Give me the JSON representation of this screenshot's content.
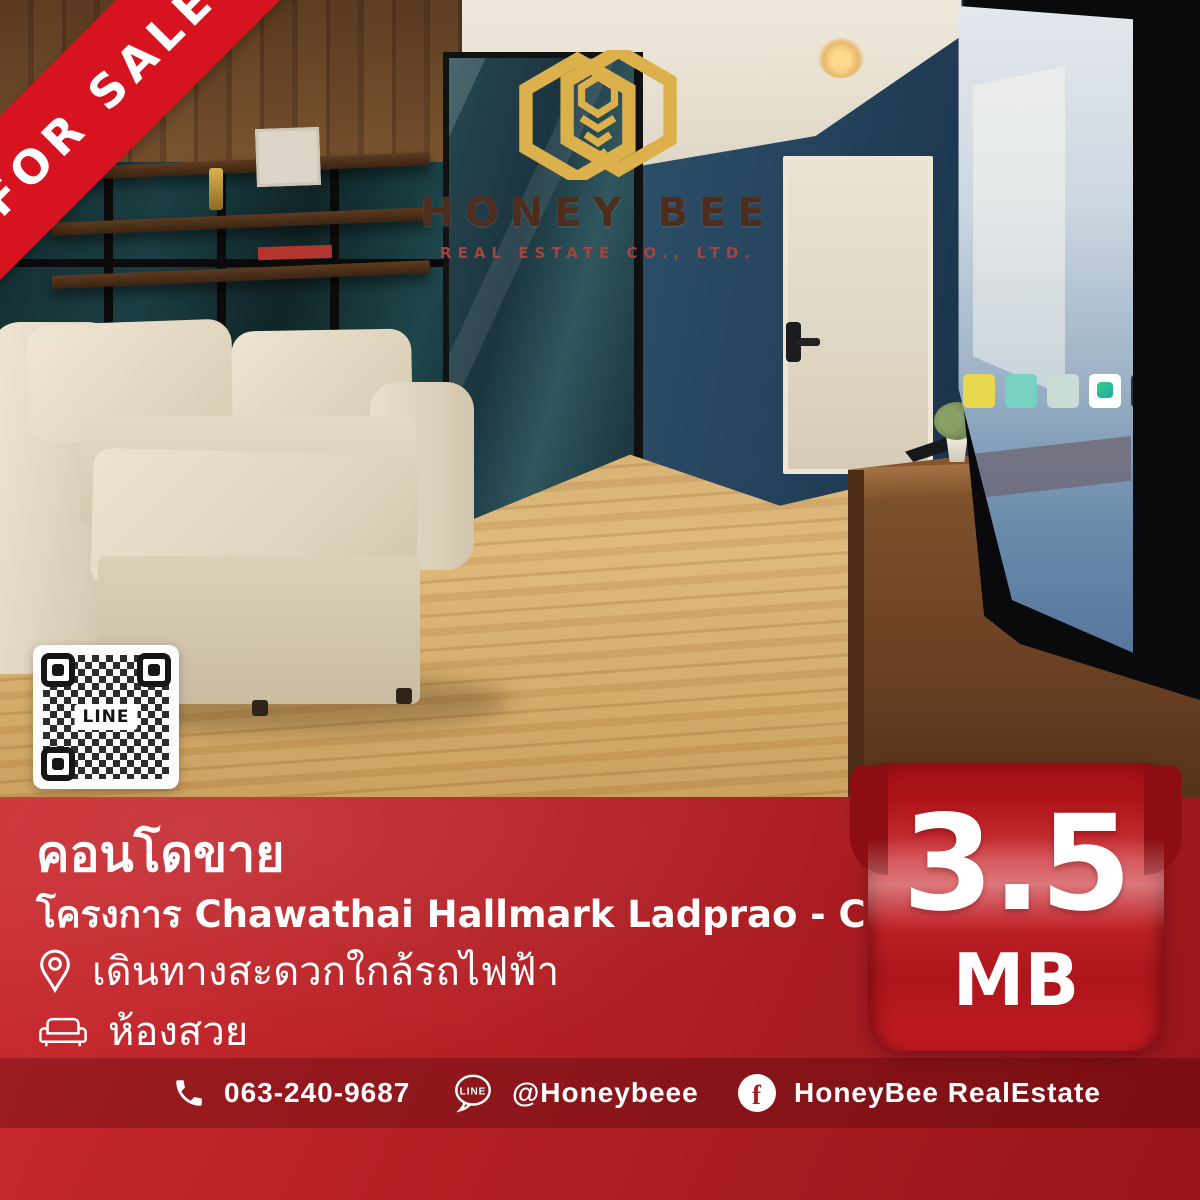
{
  "ribbon": {
    "label": "FOR SALE"
  },
  "logo": {
    "name": "HONEY BEE",
    "subtitle": "REAL ESTATE CO., LTD."
  },
  "qr_card": {
    "label": "LINE"
  },
  "listing": {
    "title": "คอนโดขาย",
    "project": "โครงการ Chawathai Hallmark Ladprao - Chokchai 4",
    "features": [
      {
        "icon": "location-pin-icon",
        "text": "เดินทางสะดวกใกล้รถไฟฟ้า"
      },
      {
        "icon": "sofa-icon",
        "text": "ห้องสวย"
      }
    ],
    "price": {
      "value": "3.5",
      "unit": "MB"
    }
  },
  "contact_bar": {
    "phone": "063-240-9687",
    "line": "@Honeybeee",
    "facebook": "HoneyBee RealEstate",
    "line_icon_label": "LINE",
    "facebook_letter": "f"
  },
  "colors": {
    "panel_red": "#b02025",
    "ribbon_red": "#d6131f",
    "badge_red": "#b5161c",
    "logo_gold": "#dcb14c",
    "logo_brown": "#4f2d1c",
    "logo_rust": "#a3453a"
  },
  "photo": {
    "description": "Living room: beige fabric sofa with ottoman, dark glass partition with wooden shelves, navy blue wall, white entrance door with digital lock, large TV on wooden console, light wooden laminate floor"
  }
}
